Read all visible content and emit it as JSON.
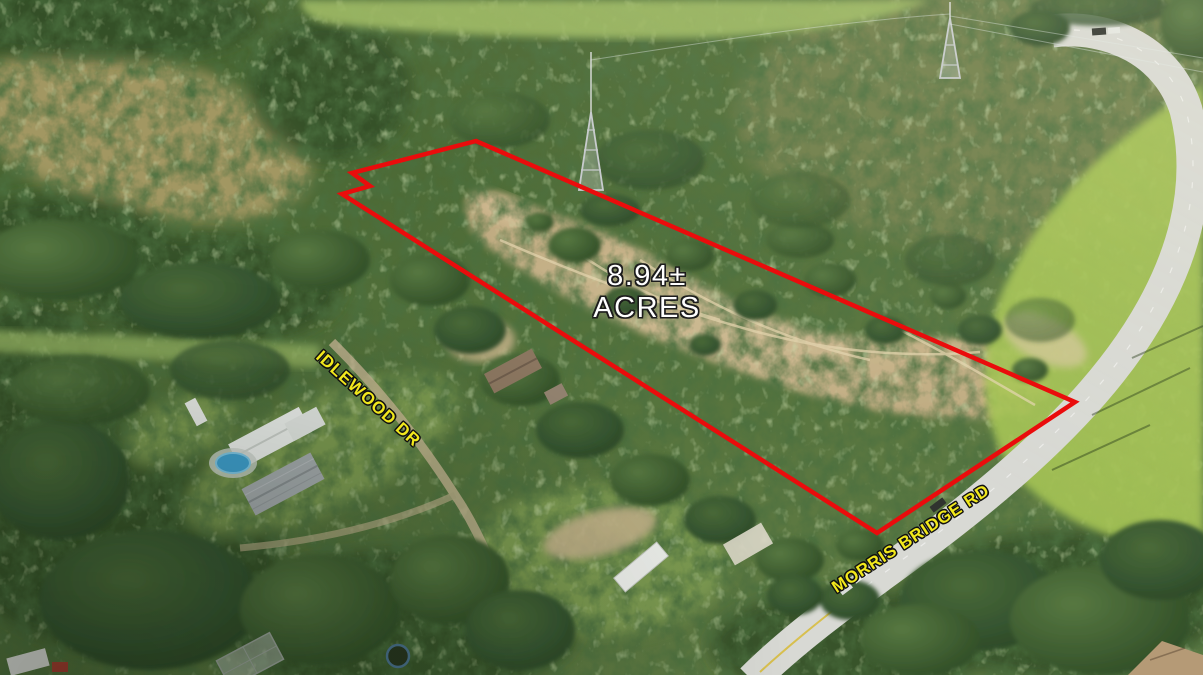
{
  "photo": {
    "description": "Aerial drone photograph of a wooded land parcel outlined in red, bordered by Morris Bridge Rd with residences along Idlewood Dr",
    "colors": {
      "forest_green": "#4f6b39",
      "sand_clearing": "#c9b086",
      "bright_field_green": "#a6c455",
      "road_gray": "#d8d9d4",
      "pool_blue": "#3e9ecd"
    }
  },
  "overlay": {
    "acreage": {
      "line1": "8.94±",
      "line2": "ACRES",
      "color": "#ffffff"
    },
    "boundary": {
      "color": "#ea0c0c",
      "stroke_width": "4.5",
      "points": "476,141 352,173 370,186 342,194 877,533 1075,402"
    },
    "street_labels": [
      {
        "name": "IDLEWOOD DR",
        "color": "#f2e81c"
      },
      {
        "name": "MORRIS BRIDGE RD",
        "color": "#f2e81c"
      }
    ]
  }
}
